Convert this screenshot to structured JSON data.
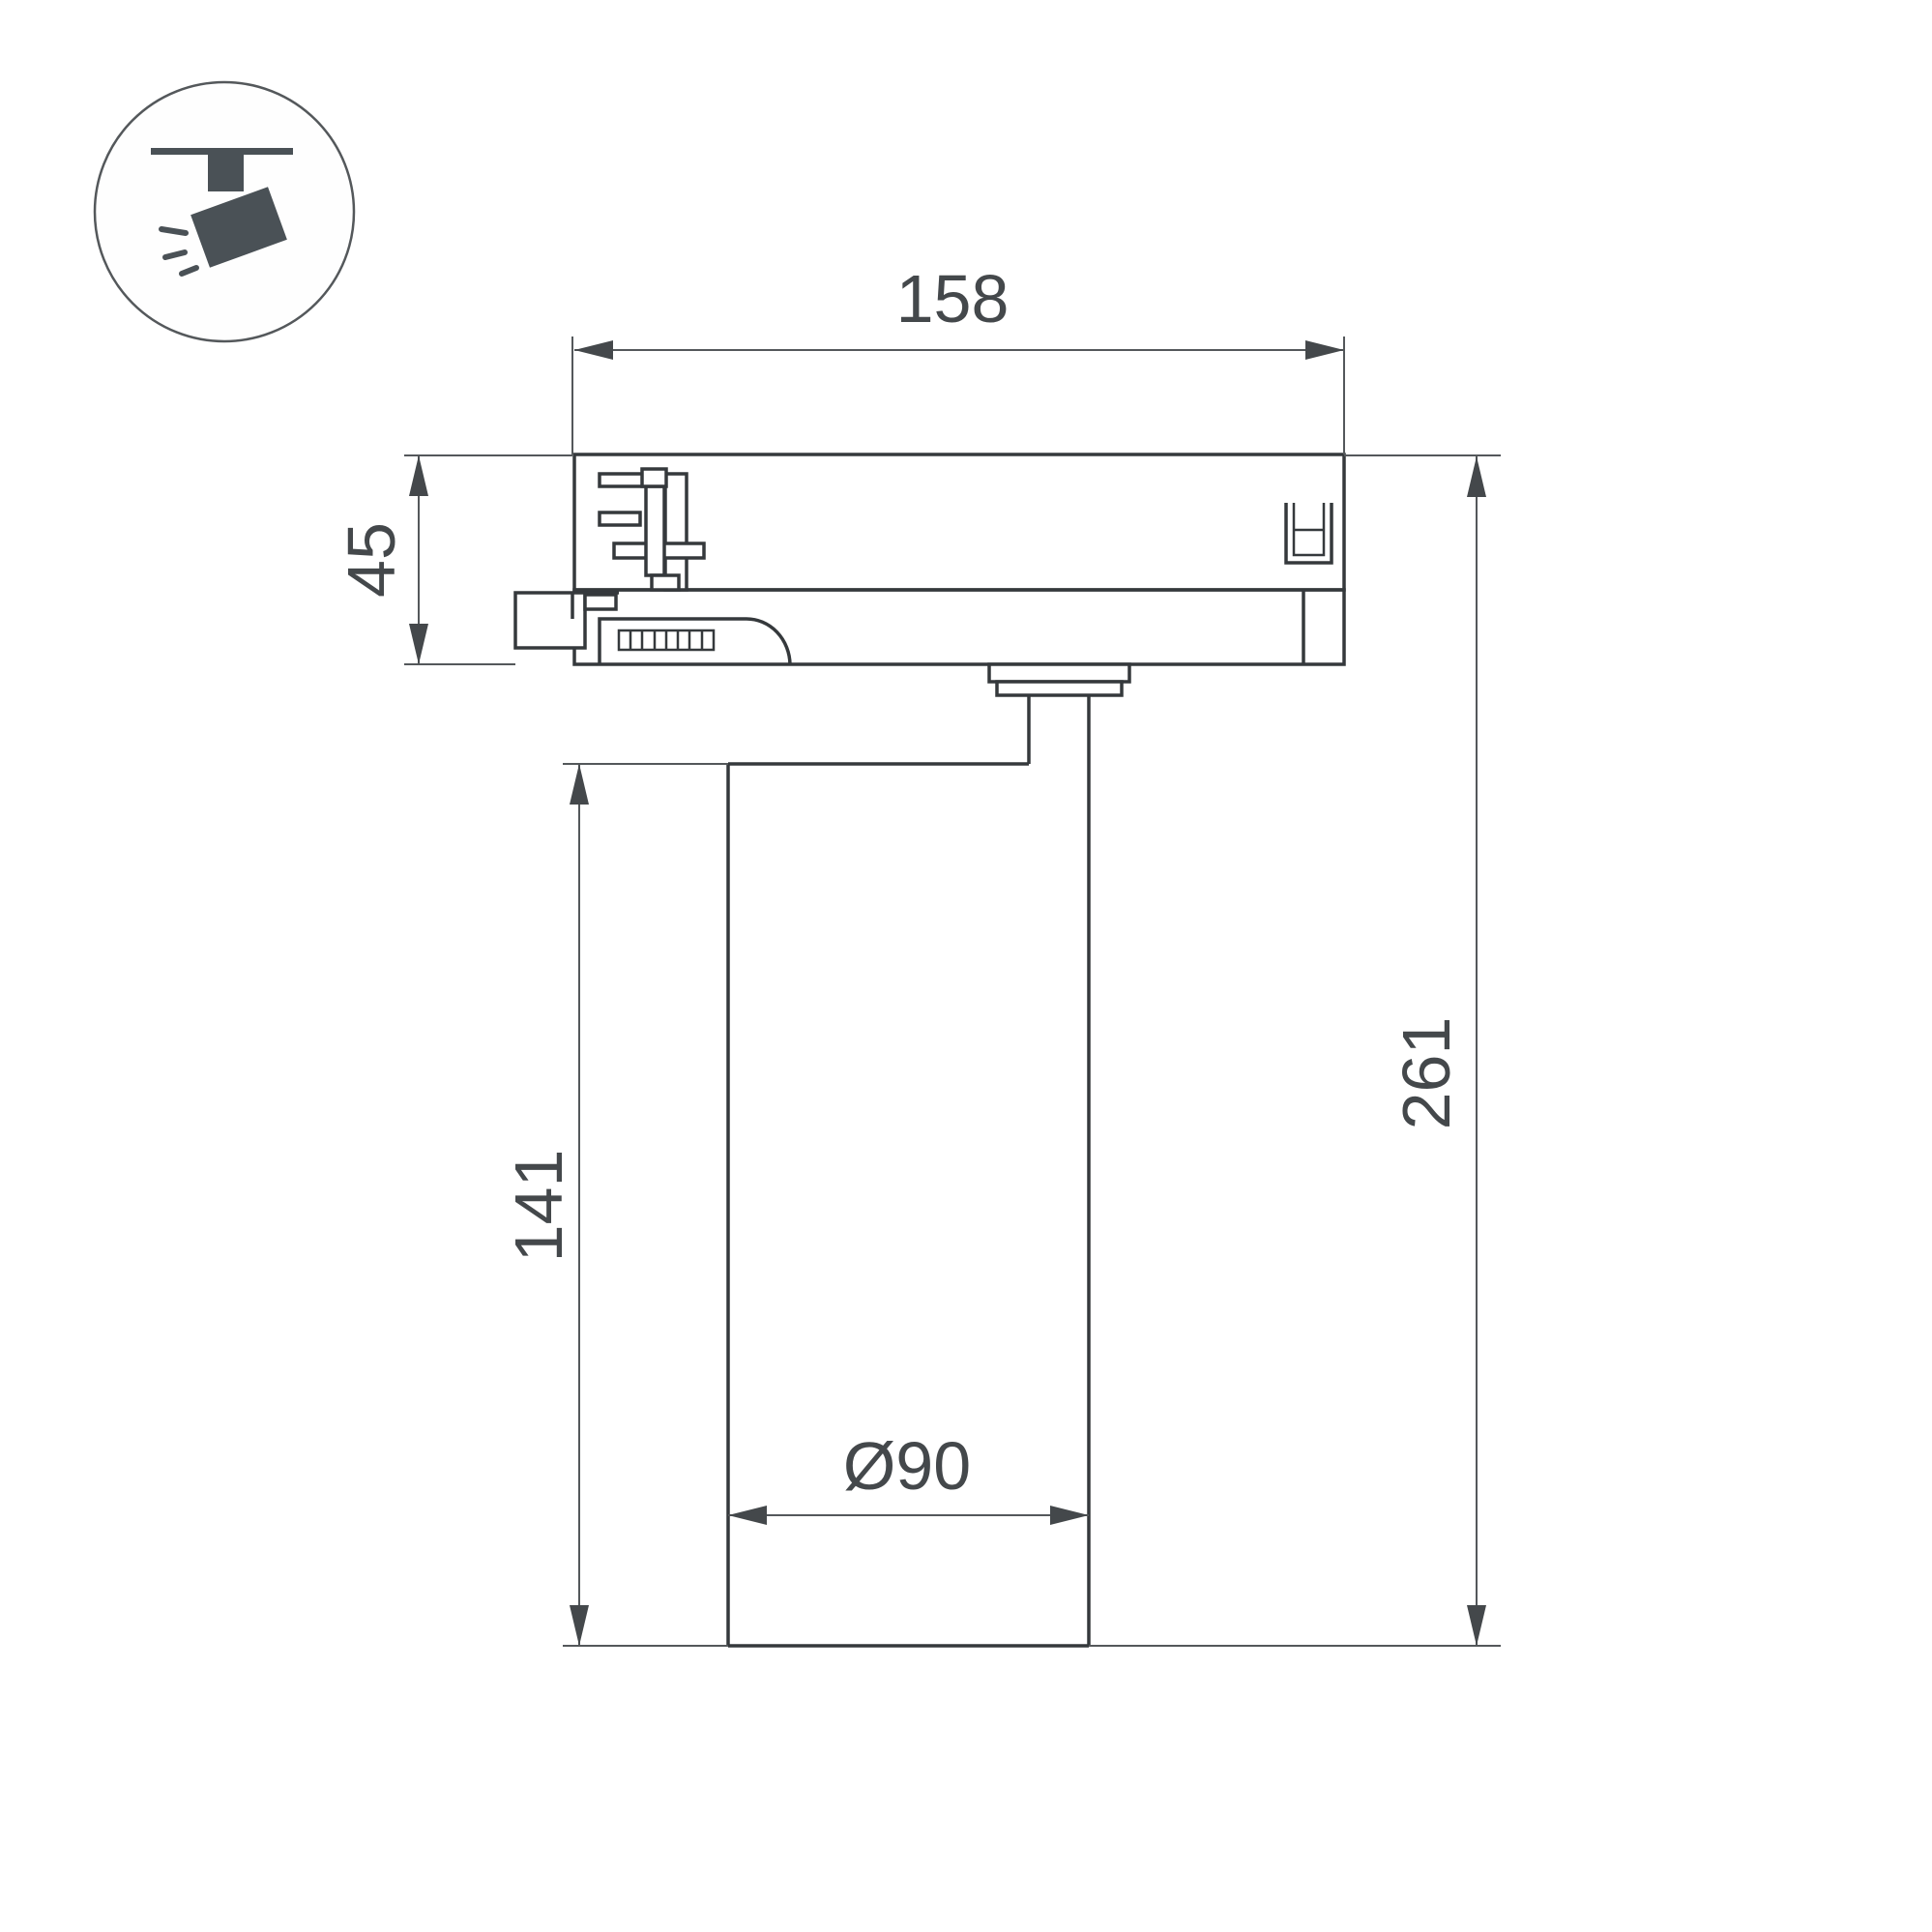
{
  "drawing": {
    "kind": "technical dimension drawing",
    "subject": "track-mounted spotlight luminaire, side view"
  },
  "icon": {
    "name": "track-spotlight-icon",
    "meaning": "spotlight hanging from ceiling track"
  },
  "dimensions": {
    "width": "158",
    "adapter_height": "45",
    "body_height": "141",
    "total_height": "261",
    "diameter": "Ø90"
  },
  "colors": {
    "background": "#ffffff",
    "line_main": "#35393c",
    "line_thin": "#54585b",
    "arrow": "#44484b",
    "text": "#44484b",
    "icon_fill": "#4a5156"
  }
}
